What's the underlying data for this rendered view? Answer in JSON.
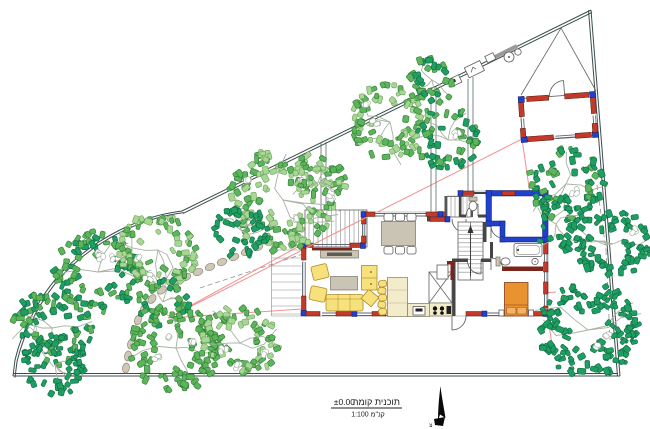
{
  "title_block": {
    "elevation": "±0.00",
    "title": "תוכנית קומה",
    "scale": "קנ\"מ 1:100"
  },
  "north": {
    "label": "צ"
  },
  "colors": {
    "boundary": "#3a4d4c",
    "setback": "#f29090",
    "wall_red": "#c23b2a",
    "wall_blue": "#1f41cc",
    "wall_maroon": "#7a241a",
    "furniture_yellow": "#f6e17d",
    "furniture_yellow_stroke": "#b08a28",
    "counter": "#f3eccb",
    "bed_orange": "#e8932f",
    "gray_furniture": "#cac4b4",
    "stone": "#cfc8b5",
    "stone_stroke": "#8a8676",
    "tree_dark": "#1f9e62",
    "tree_dark_stroke": "#0c6b40",
    "tree_medium": "#5cb45c",
    "tree_medium_stroke": "#2e7d32",
    "tree_light": "#a8d694",
    "tree_light_stroke": "#6aa35c",
    "text": "#1c1c1c"
  },
  "site": {
    "trees": [
      {
        "cx": 52,
        "cy": 328,
        "r": 40,
        "p": [
          "dark",
          "medium"
        ],
        "w": 2
      },
      {
        "cx": 98,
        "cy": 272,
        "r": 44,
        "p": [
          "medium",
          "dark"
        ],
        "w": 3
      },
      {
        "cx": 158,
        "cy": 250,
        "r": 40,
        "p": [
          "medium",
          "light"
        ],
        "w": 2
      },
      {
        "cx": 55,
        "cy": 365,
        "r": 32,
        "p": [
          "dark"
        ],
        "w": 0
      },
      {
        "cx": 163,
        "cy": 302,
        "r": 26,
        "p": [
          "dark",
          "medium"
        ],
        "w": 0
      },
      {
        "cx": 283,
        "cy": 200,
        "r": 54,
        "p": [
          "medium",
          "light"
        ],
        "w": 5
      },
      {
        "cx": 243,
        "cy": 232,
        "r": 28,
        "p": [
          "dark"
        ],
        "w": 0
      },
      {
        "cx": 390,
        "cy": 122,
        "r": 40,
        "p": [
          "medium",
          "light"
        ],
        "w": 2
      },
      {
        "cx": 448,
        "cy": 140,
        "r": 33,
        "p": [
          "medium",
          "dark"
        ],
        "w": 1
      },
      {
        "cx": 432,
        "cy": 80,
        "r": 25,
        "p": [
          "medium",
          "dark"
        ],
        "w": 0
      },
      {
        "cx": 318,
        "cy": 182,
        "r": 28,
        "p": [
          "light",
          "medium"
        ],
        "w": 1,
        "d": 26
      },
      {
        "cx": 566,
        "cy": 184,
        "r": 38,
        "p": [
          "dark",
          "medium"
        ],
        "w": 1
      },
      {
        "cx": 613,
        "cy": 244,
        "r": 38,
        "p": [
          "dark"
        ],
        "w": 1
      },
      {
        "cx": 588,
        "cy": 330,
        "r": 50,
        "p": [
          "dark"
        ],
        "w": 2
      },
      {
        "cx": 556,
        "cy": 224,
        "r": 30,
        "p": [
          "dark"
        ],
        "d": 34,
        "w": 0
      },
      {
        "cx": 176,
        "cy": 348,
        "r": 46,
        "p": [
          "medium"
        ],
        "w": 3
      },
      {
        "cx": 240,
        "cy": 343,
        "r": 38,
        "p": [
          "light",
          "medium"
        ],
        "w": 3
      }
    ],
    "stones": [
      [
        258,
        247
      ],
      [
        246,
        252
      ],
      [
        234,
        257
      ],
      [
        222,
        262
      ],
      [
        210,
        267
      ],
      [
        198,
        272
      ],
      [
        186,
        277
      ],
      [
        174,
        283
      ],
      [
        162,
        290
      ],
      [
        152,
        299
      ],
      [
        144,
        309
      ],
      [
        138,
        320
      ],
      [
        134,
        332
      ],
      [
        131,
        344
      ],
      [
        128,
        356
      ],
      [
        126,
        368
      ]
    ],
    "pink_lines": [
      [
        168,
        318,
        522,
        139
      ],
      [
        522,
        139,
        552,
        345
      ],
      [
        168,
        318,
        556,
        292
      ],
      [
        168,
        318,
        303,
        244
      ]
    ],
    "pink_overlay": [
      [
        306,
        248,
        367,
        217
      ]
    ],
    "gray_dashed": [
      [
        200,
        288,
        330,
        245
      ],
      [
        597,
        185,
        606,
        250
      ],
      [
        606,
        250,
        610,
        340
      ]
    ]
  }
}
